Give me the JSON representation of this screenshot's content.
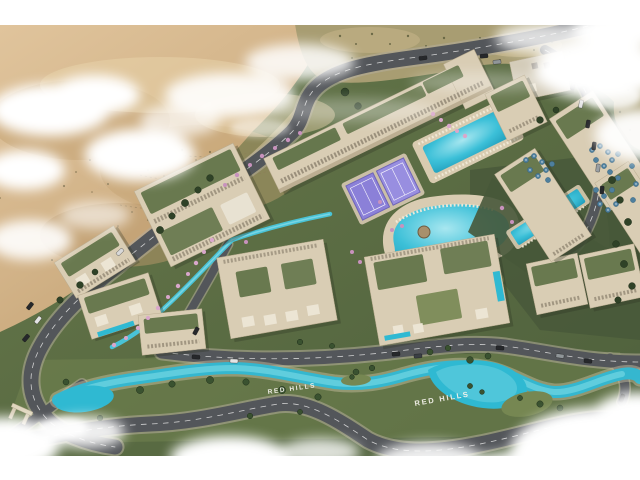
{
  "scene": {
    "description": "Aerial 3D architectural rendering of the Red Hills resort master plan: beige apartment blocks with planted roofs, lagoon pools, a winding turquoise lazy river, purple padel courts, desert dunes behind and clouds around the edges",
    "project_name": "Red Hills",
    "labels": {
      "hillside_sign": "Red Hills",
      "river_text_left": "RED HILLS",
      "river_text_right": "RED HILLS"
    },
    "colors": {
      "sand": "#d2b388",
      "sand_shadow": "#bb9a6b",
      "scrub": "#a89d72",
      "grass": "#5d6f46",
      "grass_dark": "#47583a",
      "grass_light": "#768752",
      "road": "#53565a",
      "road_line": "#e6e6e6",
      "sidewalk": "#b5ad9c",
      "building_wall": "#d9cdb4",
      "building_shade": "#b4a68a",
      "roof_garden": "#5c7044",
      "pool": "#2fb9d2",
      "pool_light": "#7fd8e6",
      "river": "#35b7cf",
      "padel_purple": "#8b80d8",
      "umbrella_blue": "#4e7f9d",
      "flower_pink": "#d9a7cb",
      "tree_green": "#2f4227",
      "cloud_white": "#ffffff",
      "car_dark": "#26282b",
      "text_white": "#f5f3ec"
    }
  }
}
